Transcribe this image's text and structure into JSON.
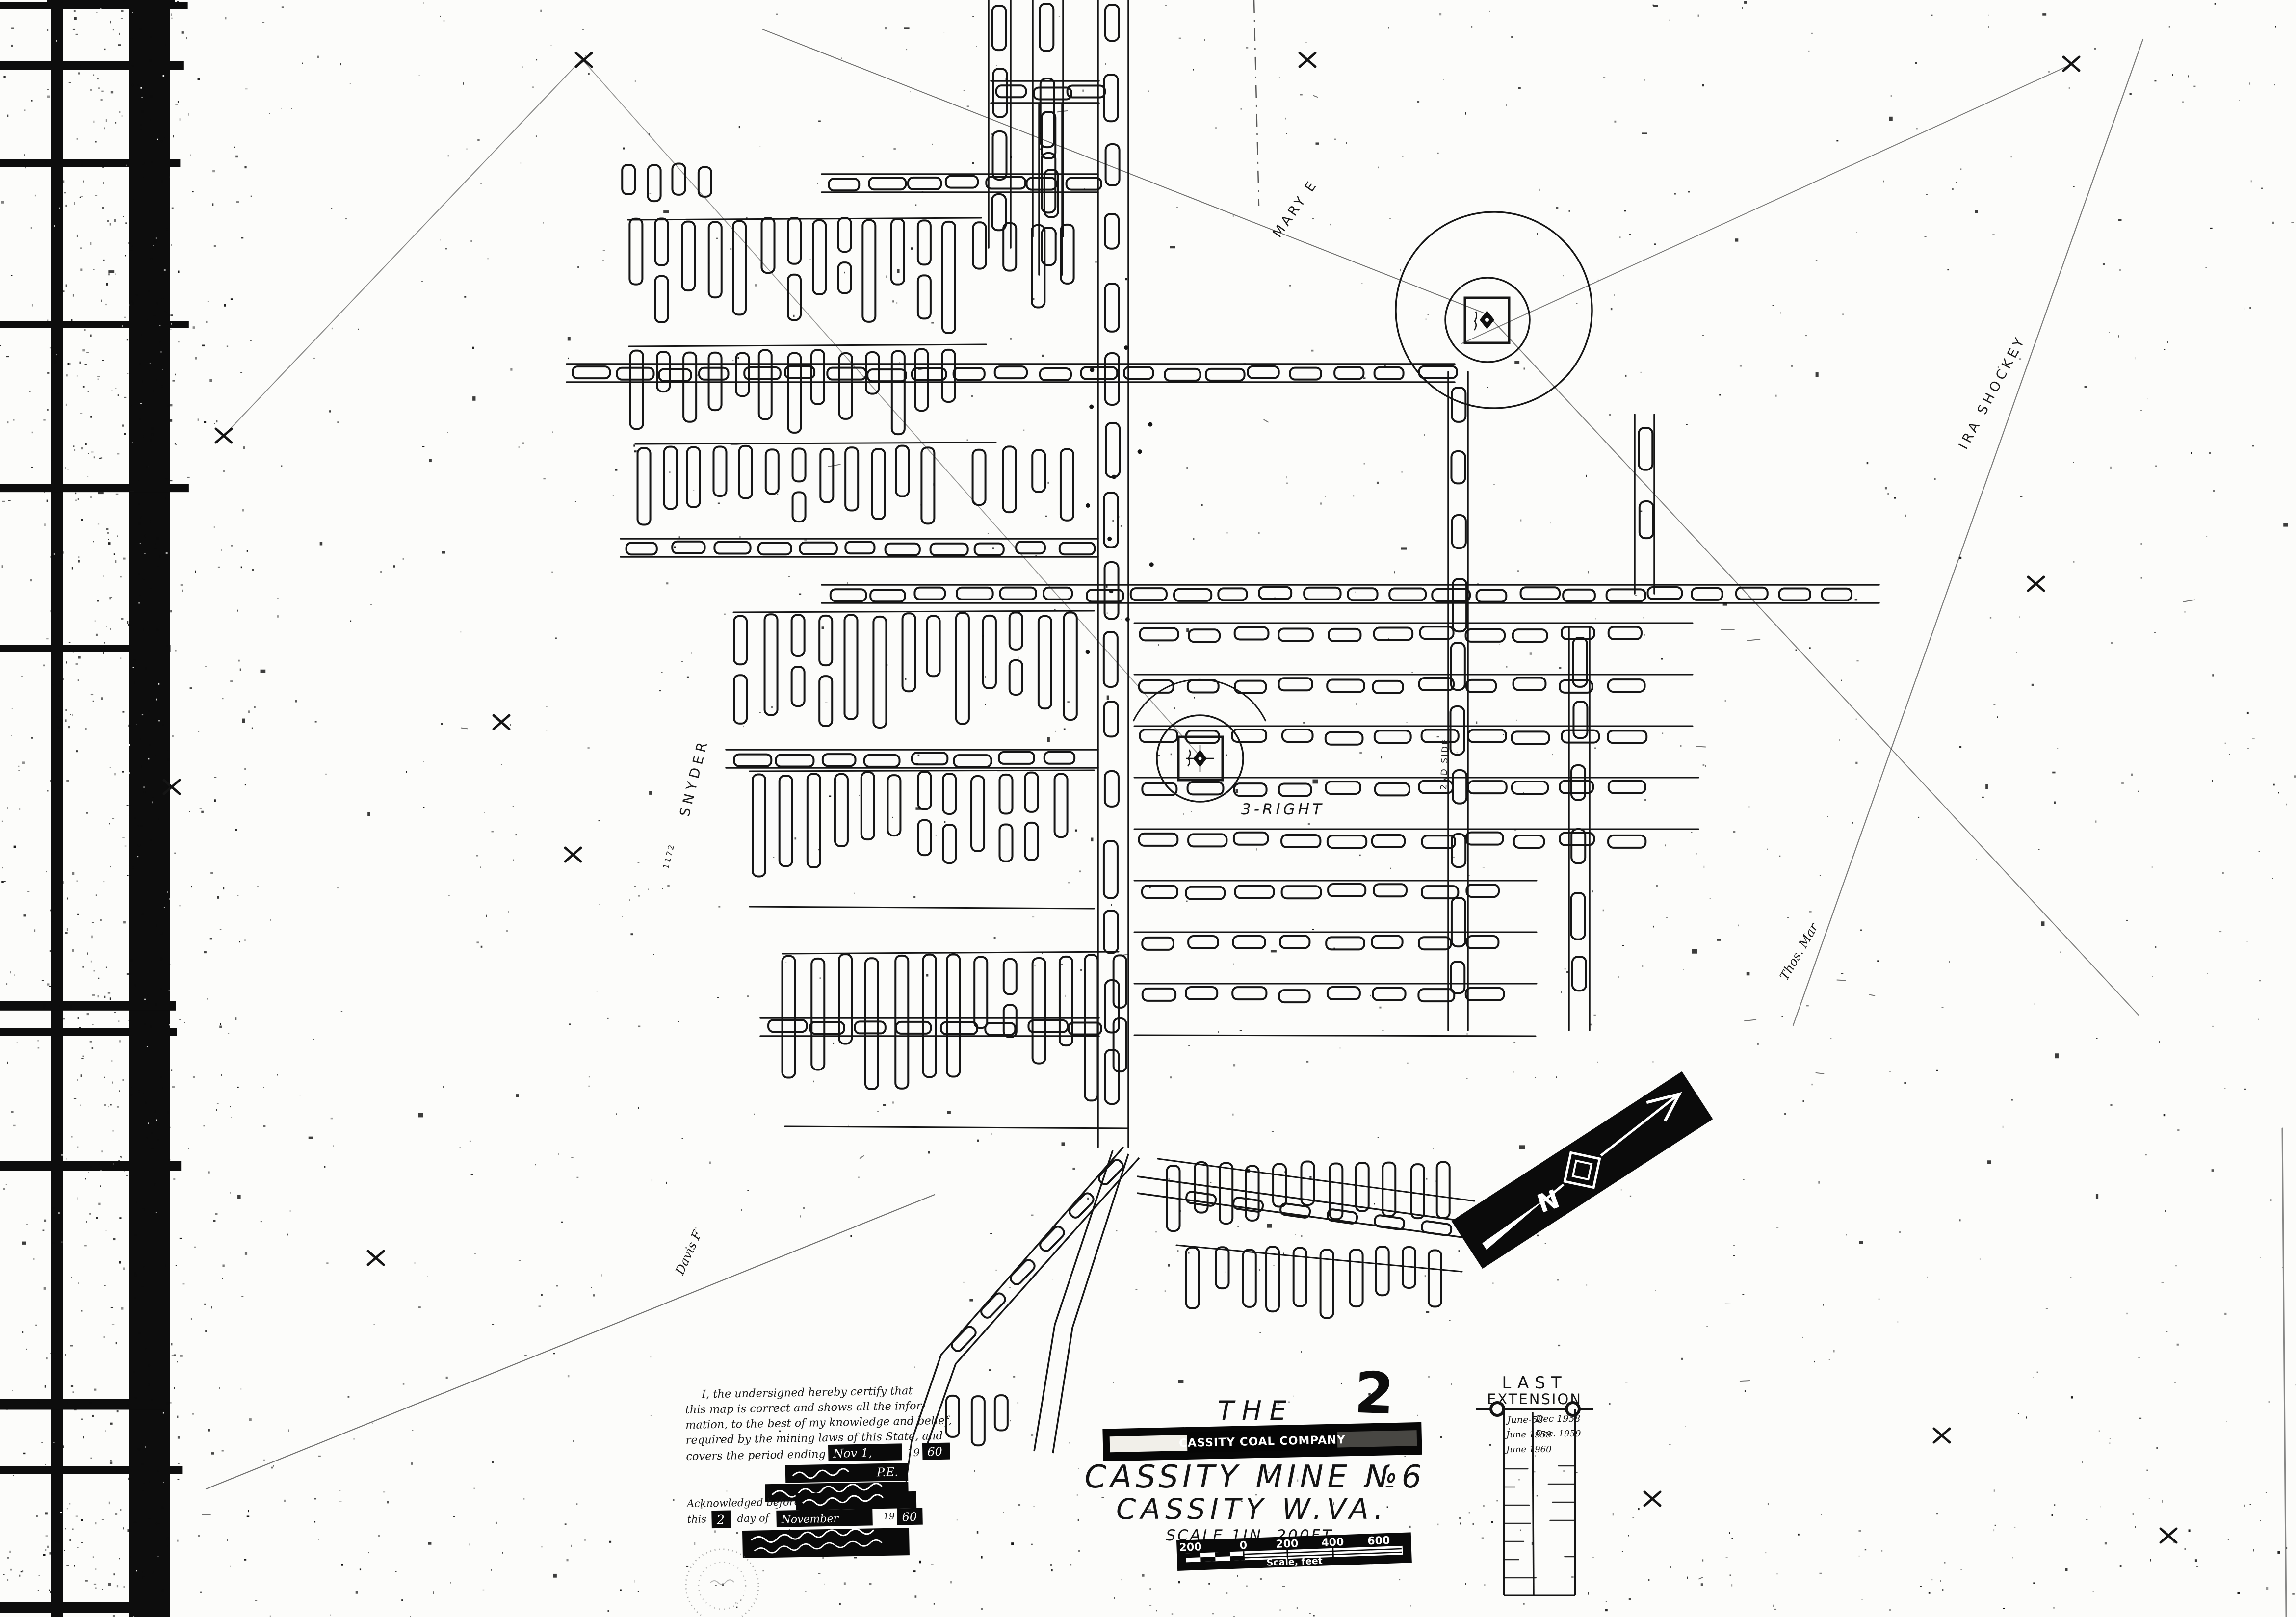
{
  "page_number": "2",
  "title_block": {
    "the": "THE",
    "company_banner": "CASSITY COAL COMPANY",
    "mine_name": "CASSITY MINE №6",
    "location": "CASSITY   W.VA.",
    "scale_note": "SCALE 1IN. 200FT."
  },
  "scale_bar": {
    "tick_200l": "200",
    "tick_0": "0",
    "tick_200r": "200",
    "tick_400": "400",
    "tick_600": "600",
    "caption": "Scale, feet"
  },
  "certification": {
    "line1": "I, the undersigned hereby certify that",
    "line2": "this map is correct and shows all the infor-",
    "line3": "mation, to the best of my knowledge and belief,",
    "line4": "required by the mining laws of this State, and",
    "line5": "covers the period ending",
    "date_script": "Nov 1,",
    "year_prefix": "19",
    "year_suffix": "60",
    "pe": "P.E.",
    "ack": "Acknowledged before me",
    "this_word": "this",
    "day_num": "2",
    "day_of": "day of",
    "month_script": "November",
    "yr2_prefix": "19",
    "yr2": "60"
  },
  "extension_table": {
    "title1": "LAST",
    "title2": "EXTENSION",
    "col1": [
      "June-58",
      "June 1959",
      "June 1960"
    ],
    "col2": [
      "Dec 1958",
      "Dec. 1959",
      ""
    ]
  },
  "labels": {
    "owner_right": "IRA SHOCKEY",
    "owner_left": "SNYDER",
    "owner_left_no": "1172",
    "owner_sw": "Davis F",
    "owner_se": "Thos. Mar",
    "entry_right": "3-RIGHT",
    "side": "2ND SIDE",
    "mary": "MARY E",
    "north": "N"
  }
}
